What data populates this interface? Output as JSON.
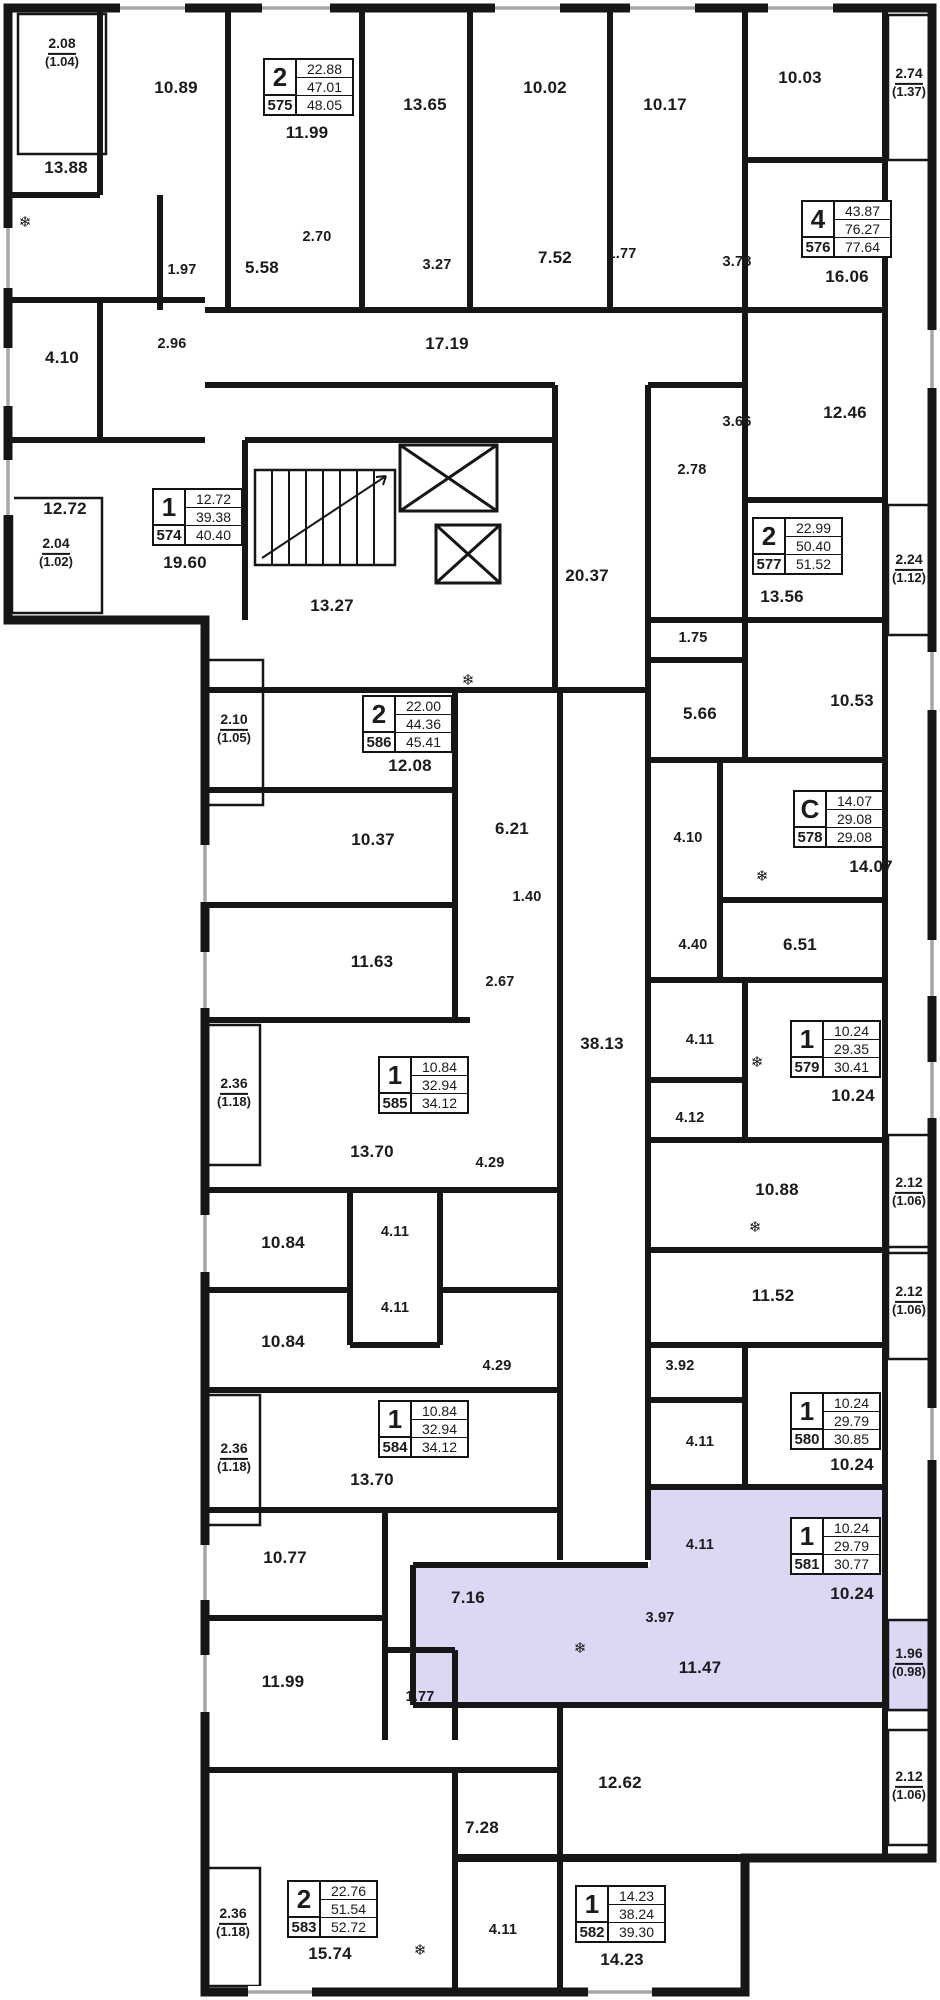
{
  "plan": {
    "highlight_color": "#dcd8f4",
    "wall_color": "#161616",
    "apartments": [
      {
        "number": "575",
        "type": "2",
        "living": "22.88",
        "area": "47.01",
        "total": "48.05",
        "x": 263,
        "y": 58,
        "highlighted": false
      },
      {
        "number": "576",
        "type": "4",
        "living": "43.87",
        "area": "76.27",
        "total": "77.64",
        "x": 801,
        "y": 200,
        "highlighted": false
      },
      {
        "number": "574",
        "type": "1",
        "living": "12.72",
        "area": "39.38",
        "total": "40.40",
        "x": 152,
        "y": 488,
        "highlighted": false
      },
      {
        "number": "577",
        "type": "2",
        "living": "22.99",
        "area": "50.40",
        "total": "51.52",
        "x": 752,
        "y": 517,
        "highlighted": false
      },
      {
        "number": "586",
        "type": "2",
        "living": "22.00",
        "area": "44.36",
        "total": "45.41",
        "x": 362,
        "y": 695,
        "highlighted": false
      },
      {
        "number": "578",
        "type": "C",
        "living": "14.07",
        "area": "29.08",
        "total": "29.08",
        "x": 793,
        "y": 790,
        "highlighted": false
      },
      {
        "number": "579",
        "type": "1",
        "living": "10.24",
        "area": "29.35",
        "total": "30.41",
        "x": 790,
        "y": 1020,
        "highlighted": false
      },
      {
        "number": "585",
        "type": "1",
        "living": "10.84",
        "area": "32.94",
        "total": "34.12",
        "x": 378,
        "y": 1056,
        "highlighted": false
      },
      {
        "number": "584",
        "type": "1",
        "living": "10.84",
        "area": "32.94",
        "total": "34.12",
        "x": 378,
        "y": 1400,
        "highlighted": false
      },
      {
        "number": "580",
        "type": "1",
        "living": "10.24",
        "area": "29.79",
        "total": "30.85",
        "x": 790,
        "y": 1392,
        "highlighted": false
      },
      {
        "number": "581",
        "type": "1",
        "living": "10.24",
        "area": "29.79",
        "total": "30.77",
        "x": 790,
        "y": 1517,
        "highlighted": true
      },
      {
        "number": "583",
        "type": "2",
        "living": "22.76",
        "area": "51.54",
        "total": "52.72",
        "x": 287,
        "y": 1880,
        "highlighted": false
      },
      {
        "number": "582",
        "type": "1",
        "living": "14.23",
        "area": "38.24",
        "total": "39.30",
        "x": 575,
        "y": 1885,
        "highlighted": false
      }
    ],
    "rooms": [
      {
        "text": "13.88",
        "x": 66,
        "y": 168
      },
      {
        "text": "10.89",
        "x": 176,
        "y": 88
      },
      {
        "text": "11.99",
        "x": 307,
        "y": 133
      },
      {
        "text": "13.65",
        "x": 425,
        "y": 105
      },
      {
        "text": "10.02",
        "x": 545,
        "y": 88
      },
      {
        "text": "10.17",
        "x": 665,
        "y": 105
      },
      {
        "text": "10.03",
        "x": 800,
        "y": 78
      },
      {
        "text": "16.06",
        "x": 847,
        "y": 277
      },
      {
        "text": "1.97",
        "x": 182,
        "y": 270,
        "s": 1
      },
      {
        "text": "2.70",
        "x": 317,
        "y": 237,
        "s": 1
      },
      {
        "text": "5.58",
        "x": 262,
        "y": 268
      },
      {
        "text": "3.27",
        "x": 437,
        "y": 265,
        "s": 1
      },
      {
        "text": "7.52",
        "x": 555,
        "y": 258
      },
      {
        "text": "1.77",
        "x": 622,
        "y": 254,
        "s": 1
      },
      {
        "text": "3.78",
        "x": 737,
        "y": 262,
        "s": 1
      },
      {
        "text": "2.96",
        "x": 172,
        "y": 344,
        "s": 1
      },
      {
        "text": "4.10",
        "x": 62,
        "y": 358
      },
      {
        "text": "17.19",
        "x": 447,
        "y": 344
      },
      {
        "text": "12.72",
        "x": 65,
        "y": 509
      },
      {
        "text": "19.60",
        "x": 185,
        "y": 563
      },
      {
        "text": "12.46",
        "x": 845,
        "y": 413
      },
      {
        "text": "3.66",
        "x": 737,
        "y": 422,
        "s": 1
      },
      {
        "text": "2.78",
        "x": 692,
        "y": 470,
        "s": 1
      },
      {
        "text": "13.56",
        "x": 782,
        "y": 597
      },
      {
        "text": "13.27",
        "x": 332,
        "y": 606
      },
      {
        "text": "20.37",
        "x": 587,
        "y": 576
      },
      {
        "text": "1.75",
        "x": 693,
        "y": 638,
        "s": 1
      },
      {
        "text": "5.66",
        "x": 700,
        "y": 714
      },
      {
        "text": "10.53",
        "x": 852,
        "y": 701
      },
      {
        "text": "12.08",
        "x": 410,
        "y": 766
      },
      {
        "text": "10.37",
        "x": 373,
        "y": 840
      },
      {
        "text": "6.21",
        "x": 512,
        "y": 829
      },
      {
        "text": "1.40",
        "x": 527,
        "y": 897,
        "s": 1
      },
      {
        "text": "11.63",
        "x": 372,
        "y": 962
      },
      {
        "text": "2.67",
        "x": 500,
        "y": 982,
        "s": 1
      },
      {
        "text": "4.10",
        "x": 688,
        "y": 838,
        "s": 1
      },
      {
        "text": "4.40",
        "x": 693,
        "y": 945,
        "s": 1
      },
      {
        "text": "6.51",
        "x": 800,
        "y": 945
      },
      {
        "text": "14.07",
        "x": 871,
        "y": 867
      },
      {
        "text": "38.13",
        "x": 602,
        "y": 1044
      },
      {
        "text": "4.11",
        "x": 700,
        "y": 1040,
        "s": 1
      },
      {
        "text": "10.24",
        "x": 853,
        "y": 1096
      },
      {
        "text": "4.12",
        "x": 690,
        "y": 1118,
        "s": 1
      },
      {
        "text": "13.70",
        "x": 372,
        "y": 1152
      },
      {
        "text": "4.29",
        "x": 490,
        "y": 1163,
        "s": 1
      },
      {
        "text": "10.88",
        "x": 777,
        "y": 1190
      },
      {
        "text": "10.84",
        "x": 283,
        "y": 1243
      },
      {
        "text": "4.11",
        "x": 395,
        "y": 1232,
        "s": 1
      },
      {
        "text": "11.52",
        "x": 773,
        "y": 1296
      },
      {
        "text": "4.11",
        "x": 395,
        "y": 1308,
        "s": 1
      },
      {
        "text": "10.84",
        "x": 283,
        "y": 1342
      },
      {
        "text": "4.29",
        "x": 497,
        "y": 1366,
        "s": 1
      },
      {
        "text": "3.92",
        "x": 680,
        "y": 1366,
        "s": 1
      },
      {
        "text": "4.11",
        "x": 700,
        "y": 1442,
        "s": 1
      },
      {
        "text": "10.24",
        "x": 852,
        "y": 1465
      },
      {
        "text": "13.70",
        "x": 372,
        "y": 1480
      },
      {
        "text": "10.77",
        "x": 285,
        "y": 1558
      },
      {
        "text": "7.16",
        "x": 468,
        "y": 1598
      },
      {
        "text": "11.99",
        "x": 283,
        "y": 1682
      },
      {
        "text": "1.77",
        "x": 420,
        "y": 1697,
        "s": 1
      },
      {
        "text": "4.11",
        "x": 700,
        "y": 1545,
        "s": 1
      },
      {
        "text": "10.24",
        "x": 852,
        "y": 1594
      },
      {
        "text": "3.97",
        "x": 660,
        "y": 1618,
        "s": 1
      },
      {
        "text": "11.47",
        "x": 700,
        "y": 1668
      },
      {
        "text": "12.62",
        "x": 620,
        "y": 1783
      },
      {
        "text": "7.28",
        "x": 482,
        "y": 1828
      },
      {
        "text": "15.74",
        "x": 330,
        "y": 1954
      },
      {
        "text": "4.11",
        "x": 503,
        "y": 1930,
        "s": 1
      },
      {
        "text": "14.23",
        "x": 622,
        "y": 1960
      }
    ],
    "balconies": [
      {
        "area": "2.08",
        "reduced": "(1.04)",
        "x": 62,
        "y": 52,
        "highlighted": false
      },
      {
        "area": "2.74",
        "reduced": "(1.37)",
        "x": 909,
        "y": 82,
        "highlighted": false
      },
      {
        "area": "2.04",
        "reduced": "(1.02)",
        "x": 56,
        "y": 552,
        "highlighted": false
      },
      {
        "area": "2.24",
        "reduced": "(1.12)",
        "x": 909,
        "y": 568,
        "highlighted": false
      },
      {
        "area": "2.10",
        "reduced": "(1.05)",
        "x": 234,
        "y": 728,
        "highlighted": false
      },
      {
        "area": "2.36",
        "reduced": "(1.18)",
        "x": 234,
        "y": 1092,
        "highlighted": false
      },
      {
        "area": "2.12",
        "reduced": "(1.06)",
        "x": 909,
        "y": 1191,
        "highlighted": false
      },
      {
        "area": "2.12",
        "reduced": "(1.06)",
        "x": 909,
        "y": 1300,
        "highlighted": false
      },
      {
        "area": "2.36",
        "reduced": "(1.18)",
        "x": 234,
        "y": 1457,
        "highlighted": false
      },
      {
        "area": "1.96",
        "reduced": "(0.98)",
        "x": 909,
        "y": 1662,
        "highlighted": true
      },
      {
        "area": "2.12",
        "reduced": "(1.06)",
        "x": 909,
        "y": 1785,
        "highlighted": false
      },
      {
        "area": "2.36",
        "reduced": "(1.18)",
        "x": 233,
        "y": 1922,
        "highlighted": false
      }
    ],
    "fixtures": [
      {
        "icon": "fridge",
        "x": 25,
        "y": 222
      },
      {
        "icon": "fridge",
        "x": 468,
        "y": 680
      },
      {
        "icon": "fridge",
        "x": 762,
        "y": 876
      },
      {
        "icon": "fridge",
        "x": 757,
        "y": 1062
      },
      {
        "icon": "fridge",
        "x": 755,
        "y": 1227
      },
      {
        "icon": "fridge",
        "x": 580,
        "y": 1648
      },
      {
        "icon": "fridge",
        "x": 420,
        "y": 1950
      }
    ]
  }
}
